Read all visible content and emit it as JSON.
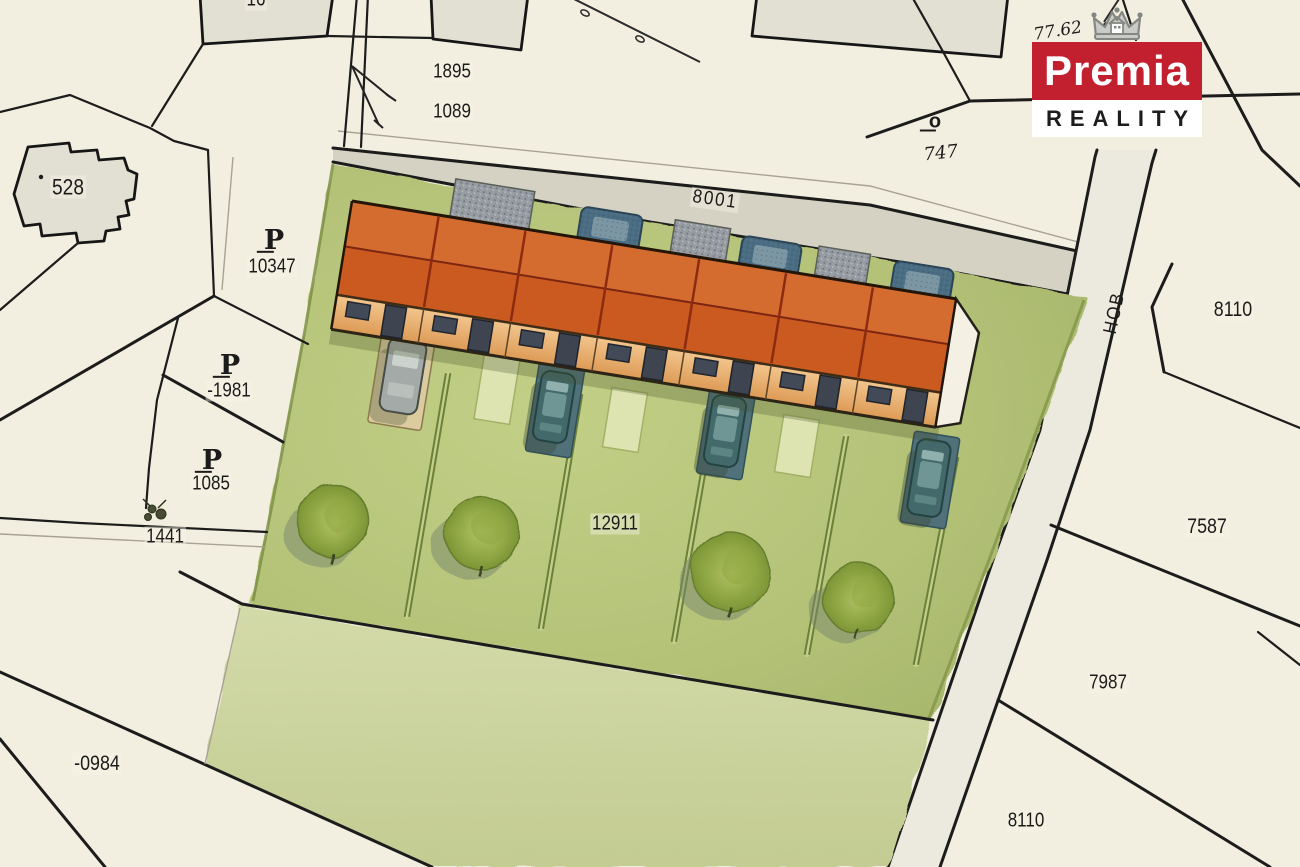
{
  "page": {
    "title": "Cadastral site plan with terraced houses"
  },
  "logo": {
    "brand": "Premia",
    "tagline": "REALITY",
    "brand_color": "#c3202f",
    "crown_icon": "crown-house-icon"
  },
  "map": {
    "labels": {
      "b528": "528",
      "sym_p": "P",
      "p10347": "10347",
      "p1981": "-1981",
      "p1085": "1085",
      "p1441": "1441",
      "p0984": "-0984",
      "p1895": "1895",
      "p1089": "1089",
      "p16": "16",
      "sym_o": "o",
      "p747": "747",
      "p8110a": "8110",
      "p7587": "7587",
      "p7987": "7987",
      "p8110b": "8110",
      "p12911": "12911",
      "handwritten": "77.62",
      "road8001": "8001",
      "roadHob": "HOB"
    },
    "colors": {
      "paper": "#f3efe0",
      "roof": "#cd5e23",
      "gardens_green": "#b7c47c",
      "lawn_green": "#cdd5a2",
      "road_grey": "#d6d2c3",
      "line_black": "#1c1c1c",
      "brand_red": "#c3202f"
    }
  }
}
